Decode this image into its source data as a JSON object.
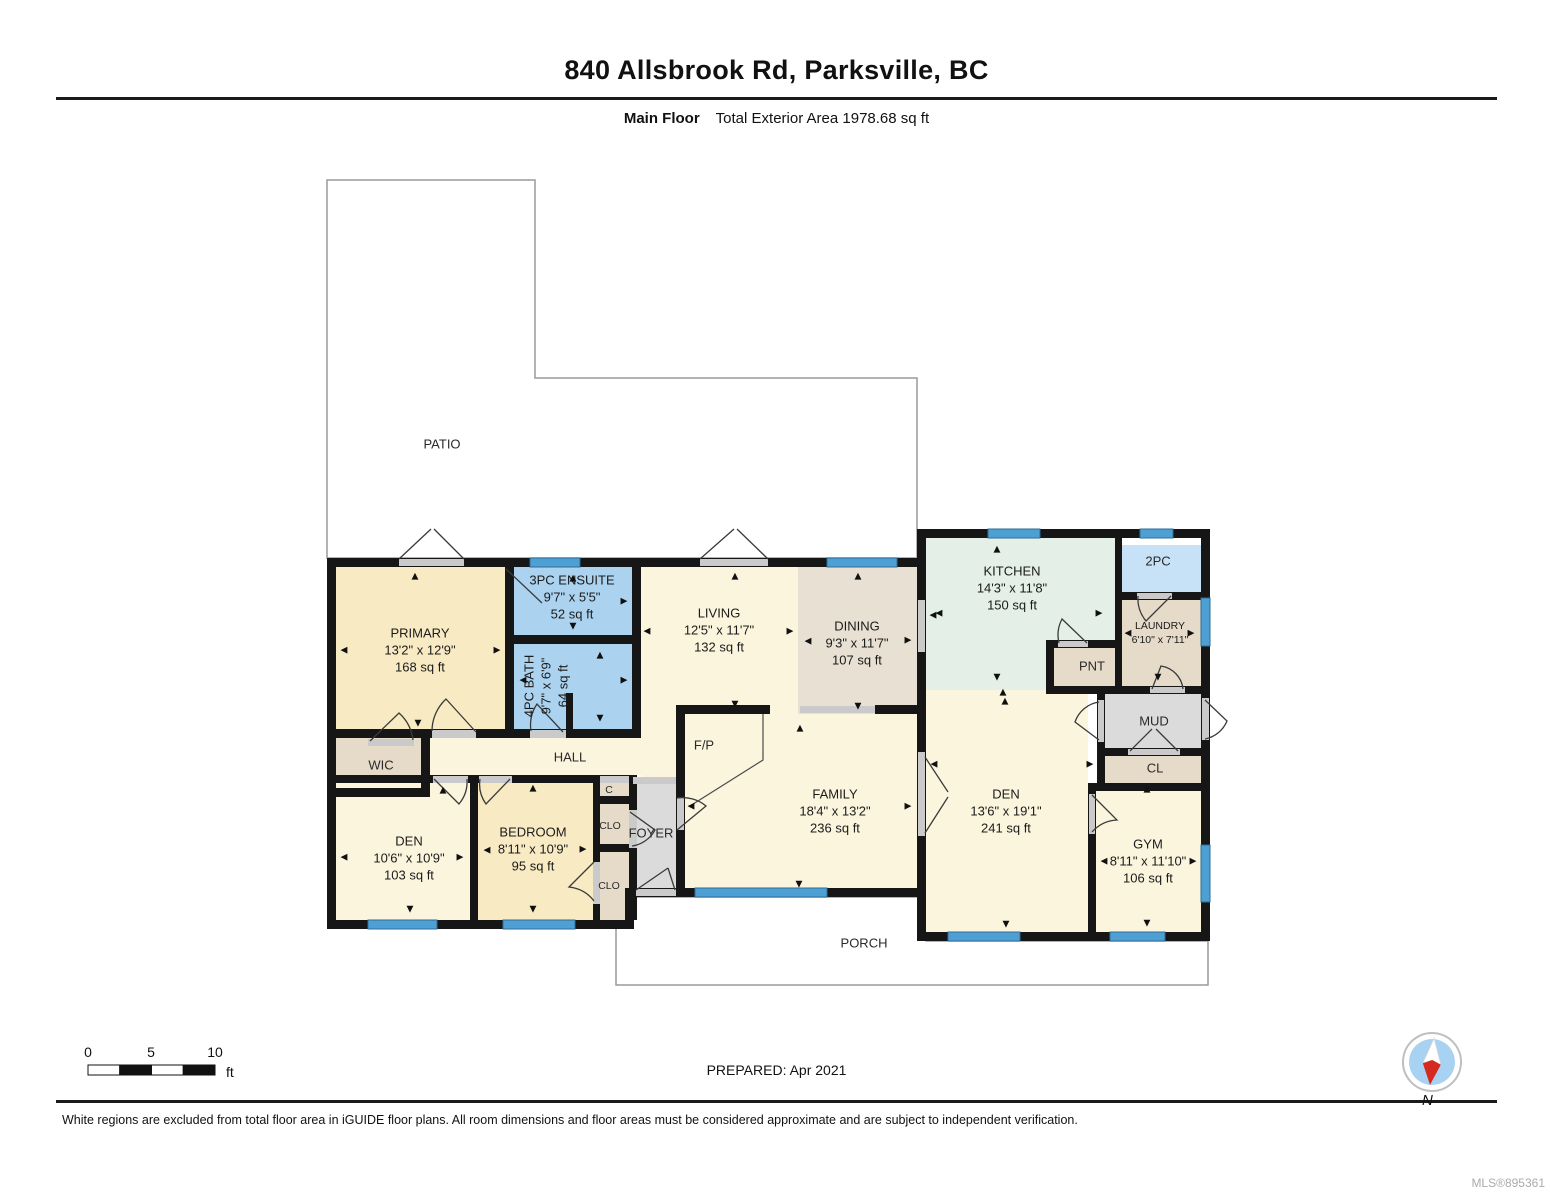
{
  "header": {
    "title": "840 Allsbrook Rd, Parksville, BC",
    "floor_label": "Main Floor",
    "area_label": "Total Exterior Area 1978.68 sq ft"
  },
  "plan": {
    "rooms": [
      {
        "name": "PRIMARY",
        "dim": "13'2\" x 12'9\"",
        "area": "168 sq ft",
        "x": 420,
        "y": 650
      },
      {
        "name": "3PC ENSUITE",
        "dim": "9'7\" x 5'5\"",
        "area": "52 sq ft",
        "x": 572,
        "y": 597
      },
      {
        "name": "4PC BATH",
        "dim": "9'7\" x 6'9\"",
        "area": "64 sq ft",
        "x": 546,
        "y": 686,
        "cls": "rot"
      },
      {
        "name": "LIVING",
        "dim": "12'5\" x 11'7\"",
        "area": "132 sq ft",
        "x": 719,
        "y": 630
      },
      {
        "name": "DINING",
        "dim": "9'3\" x 11'7\"",
        "area": "107 sq ft",
        "x": 857,
        "y": 643
      },
      {
        "name": "KITCHEN",
        "dim": "14'3\" x 11'8\"",
        "area": "150 sq ft",
        "x": 1012,
        "y": 588
      },
      {
        "name": "LAUNDRY",
        "dim": "6'10\" x 7'11\"",
        "area": "",
        "x": 1160,
        "y": 634,
        "cls": "sm"
      },
      {
        "name": "FAMILY",
        "dim": "18'4\" x 13'2\"",
        "area": "236 sq ft",
        "x": 835,
        "y": 811
      },
      {
        "name": "DEN",
        "dim": "13'6\" x 19'1\"",
        "area": "241 sq ft",
        "x": 1006,
        "y": 811
      },
      {
        "name": "GYM",
        "dim": "8'11\" x 11'10\"",
        "area": "106 sq ft",
        "x": 1148,
        "y": 861
      },
      {
        "name": "DEN",
        "dim": "10'6\" x 10'9\"",
        "area": "103 sq ft",
        "x": 409,
        "y": 858
      },
      {
        "name": "BEDROOM",
        "dim": "8'11\" x 10'9\"",
        "area": "95 sq ft",
        "x": 533,
        "y": 849
      }
    ],
    "labels": [
      {
        "text": "PATIO",
        "x": 442,
        "y": 444
      },
      {
        "text": "PORCH",
        "x": 864,
        "y": 943
      },
      {
        "text": "WIC",
        "x": 381,
        "y": 765
      },
      {
        "text": "HALL",
        "x": 570,
        "y": 757
      },
      {
        "text": "FOYER",
        "x": 651,
        "y": 833
      },
      {
        "text": "F/P",
        "x": 704,
        "y": 745
      },
      {
        "text": "C",
        "x": 609,
        "y": 790,
        "cls": "sm"
      },
      {
        "text": "CLO",
        "x": 610,
        "y": 826,
        "cls": "sm"
      },
      {
        "text": "CLO",
        "x": 609,
        "y": 886,
        "cls": "sm"
      },
      {
        "text": "PNT",
        "x": 1092,
        "y": 666
      },
      {
        "text": "MUD",
        "x": 1154,
        "y": 721
      },
      {
        "text": "CL",
        "x": 1155,
        "y": 768
      },
      {
        "text": "2PC",
        "x": 1158,
        "y": 561
      }
    ],
    "arrows": [
      {
        "x": 415,
        "y": 577,
        "d": "u"
      },
      {
        "x": 344,
        "y": 651,
        "d": "l"
      },
      {
        "x": 497,
        "y": 651,
        "d": "r"
      },
      {
        "x": 418,
        "y": 724,
        "d": "d"
      },
      {
        "x": 573,
        "y": 579,
        "d": "u"
      },
      {
        "x": 624,
        "y": 602,
        "d": "r"
      },
      {
        "x": 573,
        "y": 627,
        "d": "d"
      },
      {
        "x": 600,
        "y": 656,
        "d": "u"
      },
      {
        "x": 523,
        "y": 681,
        "d": "l"
      },
      {
        "x": 624,
        "y": 681,
        "d": "r"
      },
      {
        "x": 600,
        "y": 719,
        "d": "d"
      },
      {
        "x": 735,
        "y": 577,
        "d": "u"
      },
      {
        "x": 647,
        "y": 632,
        "d": "l"
      },
      {
        "x": 790,
        "y": 632,
        "d": "r"
      },
      {
        "x": 735,
        "y": 705,
        "d": "d"
      },
      {
        "x": 858,
        "y": 577,
        "d": "u"
      },
      {
        "x": 808,
        "y": 642,
        "d": "l"
      },
      {
        "x": 908,
        "y": 641,
        "d": "r"
      },
      {
        "x": 858,
        "y": 707,
        "d": "d"
      },
      {
        "x": 933,
        "y": 616,
        "d": "l"
      },
      {
        "x": 997,
        "y": 550,
        "d": "u"
      },
      {
        "x": 939,
        "y": 614,
        "d": "l"
      },
      {
        "x": 1099,
        "y": 614,
        "d": "r"
      },
      {
        "x": 997,
        "y": 678,
        "d": "d"
      },
      {
        "x": 1003,
        "y": 693,
        "d": "u"
      },
      {
        "x": 1128,
        "y": 634,
        "d": "l"
      },
      {
        "x": 1191,
        "y": 634,
        "d": "r"
      },
      {
        "x": 1158,
        "y": 678,
        "d": "d"
      },
      {
        "x": 800,
        "y": 729,
        "d": "u"
      },
      {
        "x": 691,
        "y": 807,
        "d": "l"
      },
      {
        "x": 908,
        "y": 807,
        "d": "r"
      },
      {
        "x": 799,
        "y": 885,
        "d": "d"
      },
      {
        "x": 1005,
        "y": 702,
        "d": "u"
      },
      {
        "x": 934,
        "y": 765,
        "d": "l"
      },
      {
        "x": 1090,
        "y": 765,
        "d": "r"
      },
      {
        "x": 1006,
        "y": 925,
        "d": "d"
      },
      {
        "x": 1147,
        "y": 790,
        "d": "u"
      },
      {
        "x": 1104,
        "y": 862,
        "d": "l"
      },
      {
        "x": 1193,
        "y": 862,
        "d": "r"
      },
      {
        "x": 1147,
        "y": 924,
        "d": "d"
      },
      {
        "x": 344,
        "y": 858,
        "d": "l"
      },
      {
        "x": 460,
        "y": 858,
        "d": "r"
      },
      {
        "x": 410,
        "y": 910,
        "d": "d"
      },
      {
        "x": 443,
        "y": 791,
        "d": "u"
      },
      {
        "x": 533,
        "y": 789,
        "d": "u"
      },
      {
        "x": 487,
        "y": 851,
        "d": "l"
      },
      {
        "x": 583,
        "y": 850,
        "d": "r"
      },
      {
        "x": 533,
        "y": 910,
        "d": "d"
      }
    ]
  },
  "scale": {
    "ticks": [
      "0",
      "5",
      "10"
    ],
    "unit": "ft"
  },
  "compass": {
    "label": "N"
  },
  "footer": {
    "prepared": "PREPARED: Apr 2021",
    "disclaimer": "White regions are excluded from total floor area in iGUIDE floor plans. All room dimensions and floor areas must be considered approximate and are subject to independent verification.",
    "mls": "MLS®895361"
  },
  "colors": {
    "room_cream": "#FBF5DE",
    "room_yellow": "#F8EBC3",
    "bath_blue": "#ABD3F0",
    "bath_blue_light": "#C7E2F7",
    "kitchen_green": "#E3EFE7",
    "dining_taupe": "#E8E1D3",
    "closet_tan": "#E6DBC9",
    "hallway_grey": "#DBDBDB",
    "window_blue": "#4E9FD4",
    "wall_black": "#161616",
    "compass_red": "#D42A20",
    "compass_blue": "#A8D2F2"
  }
}
